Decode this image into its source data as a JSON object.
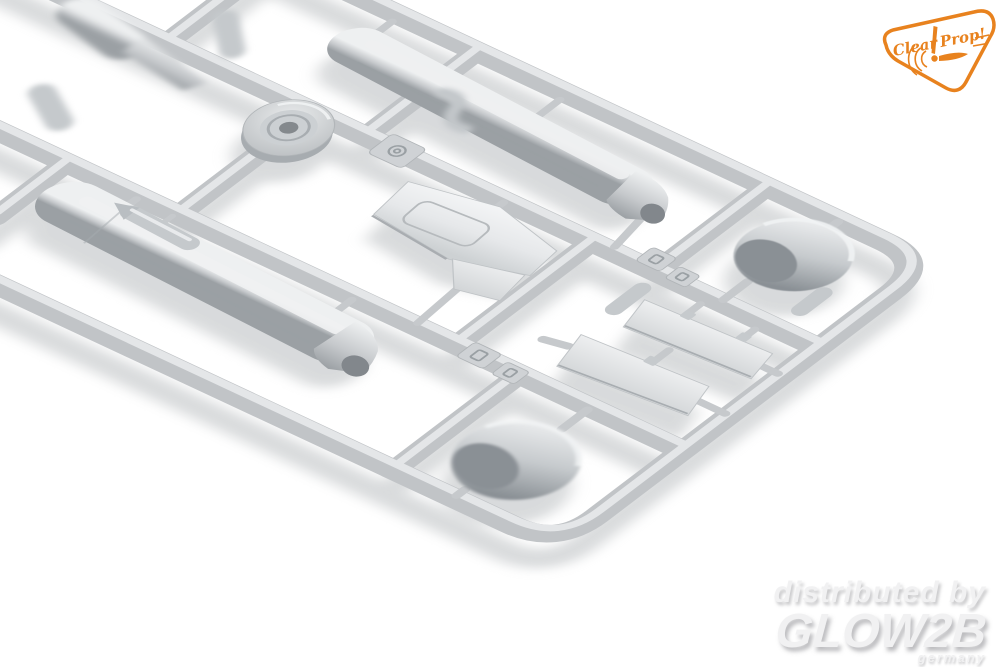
{
  "photo": {
    "subject": "Light-gray injection-molded plastic model kit sprue with aircraft parts photographed at an angle on a white studio background, shallow depth of field",
    "background_color": "#ffffff",
    "plastic_color": "#c3c6c9",
    "plastic_highlight": "#e6e8ea",
    "plastic_shadow": "#989da1",
    "parts": [
      "sprue-frame-runners",
      "large-drop-tank",
      "drop-tank-with-flared-tail",
      "engine-cowling-shell-right",
      "engine-cowling-shell-bottom",
      "flat-wing-panel-with-hatch-line",
      "flat-stabilizer-plate-upper",
      "flat-stabilizer-plate-lower",
      "round-cowl-ring-disk",
      "embossed-letter-tags",
      "small-pylon-stubs",
      "out-of-focus-parts-top-left"
    ]
  },
  "logo": {
    "brand": "Clear Prop!",
    "word1": "Clear",
    "word2": "Prop!",
    "color": "#e8821e"
  },
  "watermark": {
    "line1": "distributed by",
    "line2": "GLOW2B",
    "line3": "germany",
    "color": "#f1f1f2"
  }
}
